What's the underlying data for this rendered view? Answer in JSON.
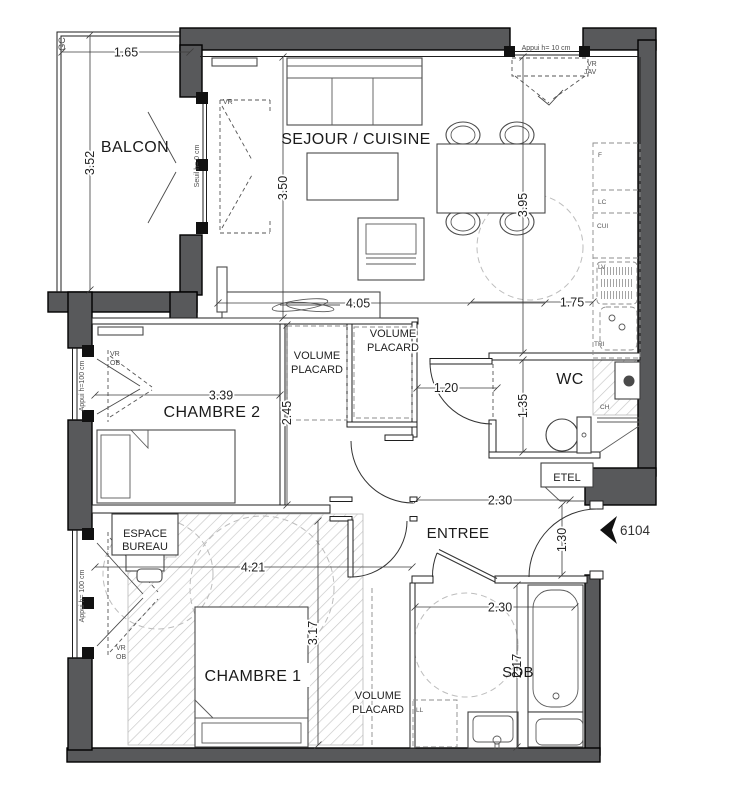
{
  "rooms": {
    "balcon": "BALCON",
    "sejour_cuisine": "SEJOUR / CUISINE",
    "chambre2": "CHAMBRE 2",
    "chambre1": "CHAMBRE 1",
    "entree": "ENTREE",
    "wc": "WC",
    "sdb": "SDB"
  },
  "zones": {
    "espace_bureau_l1": "ESPACE",
    "espace_bureau_l2": "BUREAU",
    "volume_l1": "VOLUME",
    "volume_l2": "PLACARD",
    "etel": "ETEL"
  },
  "dimensions": {
    "balcon_width": "1.65",
    "balcon_depth": "3.52",
    "sejour_depth": "3.50",
    "cuisine_depth": "3.95",
    "sejour_width": "4.05",
    "cuisine_width": "1.75",
    "chambre2_width": "3.39",
    "chambre2_depth": "2.45",
    "wc_width": "1.20",
    "wc_depth": "1.35",
    "entree_width": "2.30",
    "entree_depth": "1.30",
    "chambre1_width": "4.21",
    "chambre1_depth": "3.17",
    "sdb_width": "2.30",
    "sdb_depth": "2.17"
  },
  "annotations": {
    "gc": "GC",
    "appui_10": "Appui h= 10 cm",
    "appui_100_ch2": "Appui h=100 cm",
    "appui_100_ch1": "Appui h= 100 cm",
    "seuil_0": "Seuil h=  0 cm",
    "vr": "VR",
    "jav": "JAV",
    "ob": "OB",
    "lot_number": "6104"
  },
  "kitchen": {
    "f": "F",
    "lc": "LC",
    "cui": "CUI",
    "lv": "LV",
    "tri": "TRI"
  },
  "fixtures": {
    "ch": "CH",
    "ll": "LL"
  }
}
